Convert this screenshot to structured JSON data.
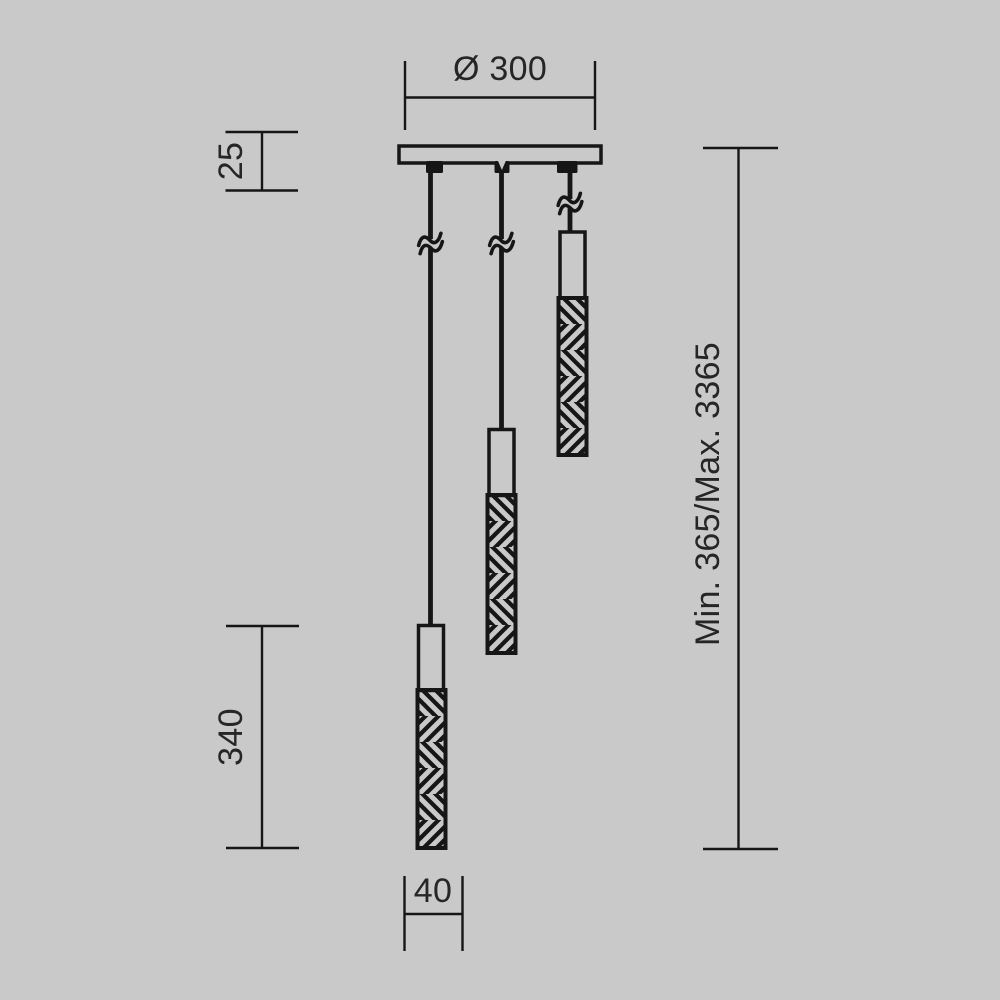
{
  "colors": {
    "background": "#c9c9c9",
    "line": "#161616",
    "text": "#262626"
  },
  "drawing_labels": {
    "canopy_diameter": "Ø 300",
    "canopy_thickness": "25",
    "shade_length": "340",
    "shade_diameter": "40",
    "suspension_height": "Min. 365/Max. 3365"
  }
}
